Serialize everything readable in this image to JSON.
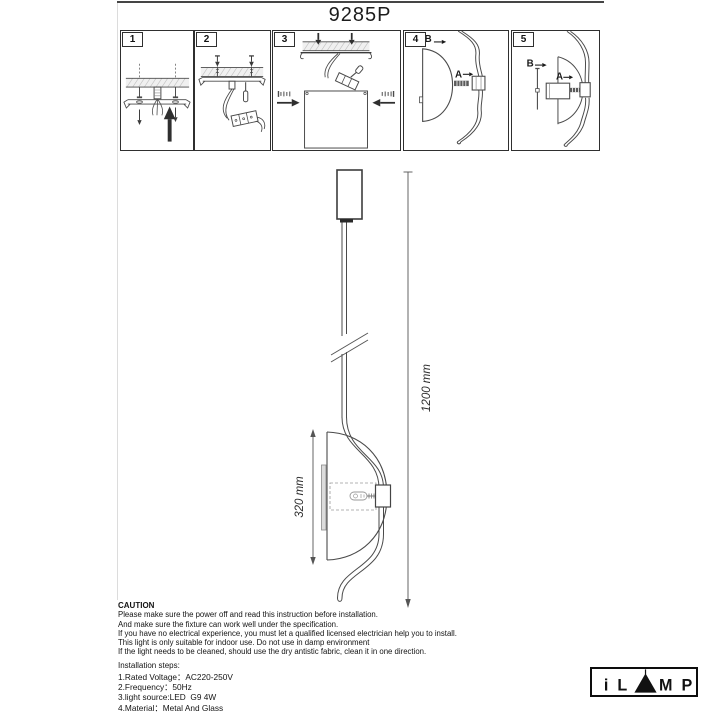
{
  "page": {
    "title": "9285P"
  },
  "steps": {
    "panel1": {
      "number": "1"
    },
    "panel2": {
      "number": "2"
    },
    "panel3": {
      "number": "3"
    },
    "panel4": {
      "number": "4",
      "label_a": "A",
      "label_b": "B"
    },
    "panel5": {
      "number": "5",
      "label_a": "A",
      "label_b": "B"
    }
  },
  "drawing": {
    "overall_height_label": "1200 mm",
    "shade_height_label": "320 mm"
  },
  "caution": {
    "heading": "CAUTION",
    "lines": [
      "Please make sure the power off and read this instruction before installation.",
      "And make sure the fixture can work well under the specification.",
      "If you have no electrical experience, you must let a qualified licensed electrician help you to install.",
      "This light is only suitable for indoor use. Do not use in damp environment",
      "If the light needs to be cleaned, should use the dry antistic fabric, clean it in one direction."
    ],
    "installation_heading": "Installation steps:"
  },
  "specs": {
    "lines": [
      "1.Rated Voltage：AC220-250V",
      "2.Frequency：50Hz",
      "3.light source:LED  G9 4W",
      "4.Material：Metal And Glass"
    ]
  },
  "logo": {
    "brand": "iLAMP",
    "letter_i": "i",
    "letter_l": "L",
    "letter_m": "M",
    "letter_p": "P"
  }
}
